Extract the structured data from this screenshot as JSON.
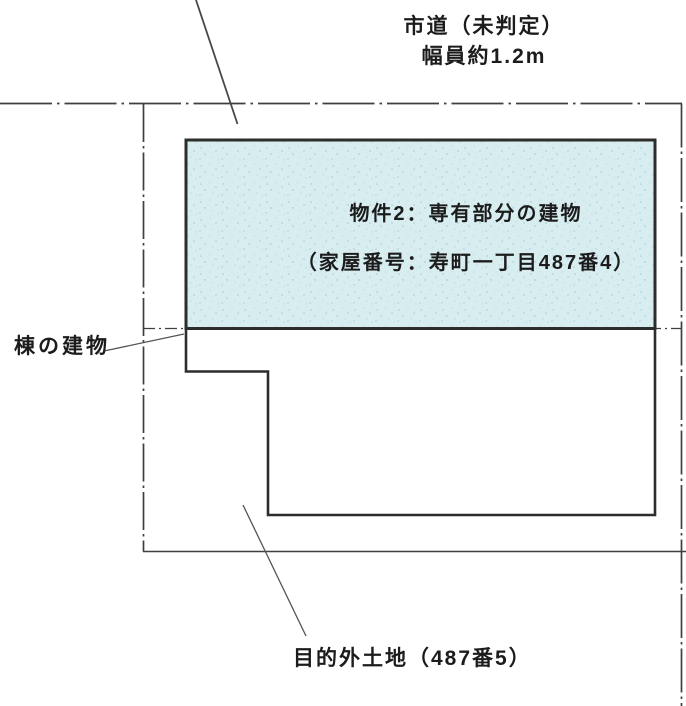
{
  "diagram": {
    "title_context": "site-plan",
    "road_label": {
      "line1": "市道（未判定）",
      "line2": "幅員約1.2m"
    },
    "unit_label": {
      "line1": "物件2：専有部分の建物",
      "line2": "（家屋番号：寿町一丁目487番4）"
    },
    "building_label": "棟の建物",
    "other_land_label": "目的外土地（487番5）",
    "colors": {
      "unit_fill": "#d7edf0",
      "unit_speckle": "#a9ccd4",
      "building_outline": "#2d2d2d",
      "boundary_line": "#3f3f3f",
      "leader_line": "#555555",
      "text": "#1c1c1c",
      "background": "#ffffff"
    }
  }
}
